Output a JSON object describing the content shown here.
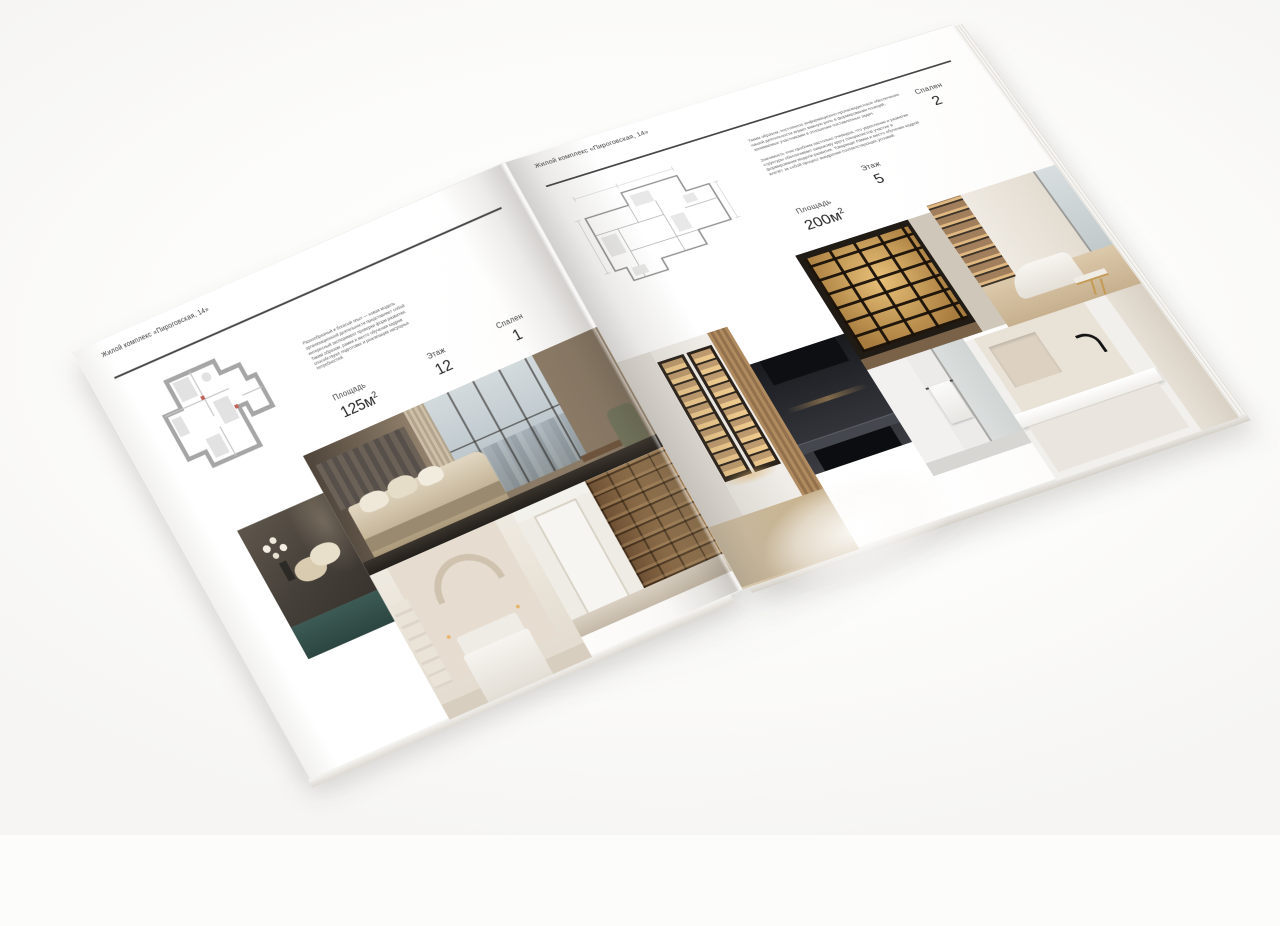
{
  "canvas": {
    "background": "#fcfcfb"
  },
  "brochure": {
    "left_page": {
      "header": "Жилой комплекс «Пироговская, 14»",
      "description": "Разнообразный и богатый опыт — новая модель организационной деятельности представляет собой интересный эксперимент проверки форм развития. Таким образом, рамки и место обучения кадров способствуют подготовке и реализации насущных потребностей.",
      "specs": {
        "area_label": "Площадь",
        "area_value": "125м",
        "area_sup": "2",
        "floor_label": "Этаж",
        "floor_value": "12",
        "bedrooms_label": "Спален",
        "bedrooms_value": "1"
      }
    },
    "right_page": {
      "header": "Жилой комплекс «Пироговская, 14»",
      "description_1": "Таким образом, постоянное информационно-пропагандистское обеспечение нашей деятельности играет важную роль в формировании позиций, занимаемых участниками в отношении поставленных задач.",
      "description_2": "Значимость этих проблем настолько очевидна, что укрепление и развитие структуры обеспечивает широкому кругу специалистов участие в формировании модели развития. Товарищи! Рамки и место обучения кадров влечёт за собой процесс внедрения соответствующих условий.",
      "specs": {
        "area_label": "Площадь",
        "area_value": "200м",
        "area_sup": "2",
        "floor_label": "Этаж",
        "floor_value": "5",
        "bedrooms_label": "Спален",
        "bedrooms_value": "2"
      }
    }
  },
  "palette": {
    "rule": "#474747",
    "text_dark": "#262626",
    "text_gray": "#5a5a5a",
    "plan_wall_gray": "#a6a6a6",
    "amber_glow": "#c69a58",
    "wood": "#8a6a46",
    "olive_chair": "#72755c",
    "teal_cabinet": "#335a54",
    "sky_window": "#c7d0d6"
  }
}
